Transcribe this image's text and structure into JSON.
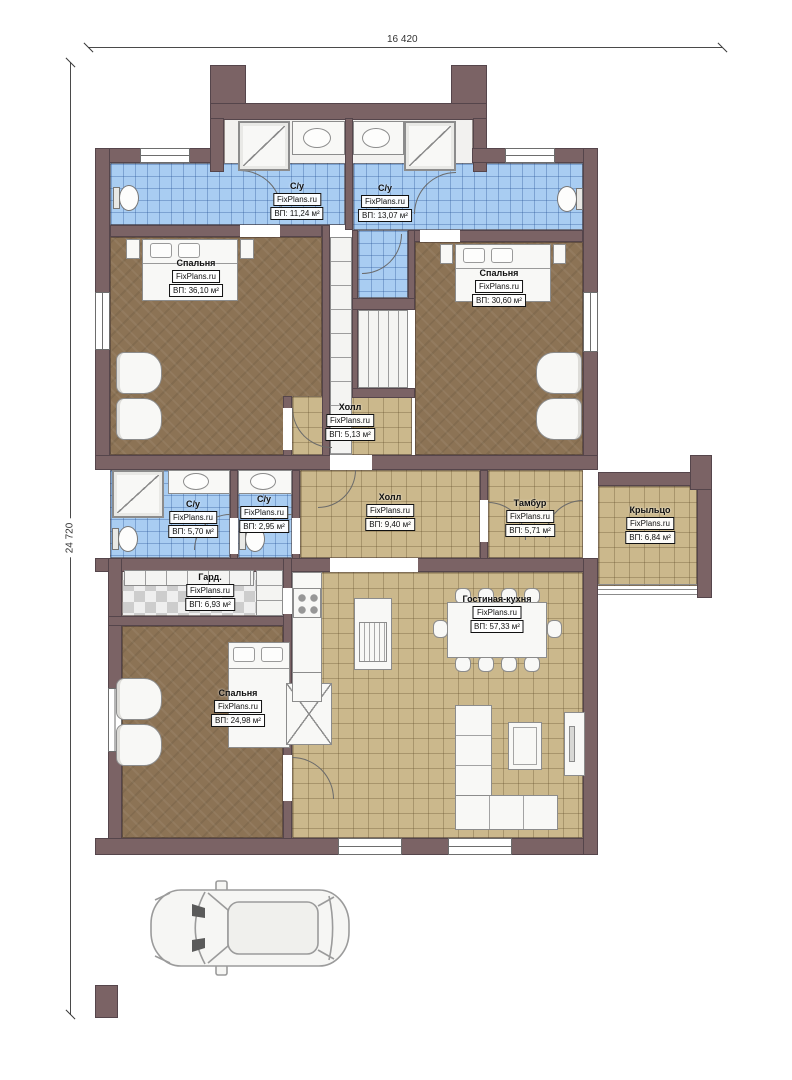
{
  "watermark": "FixPlans.ru",
  "dimensions": {
    "width": "16 420",
    "height": "24 720"
  },
  "rooms": [
    {
      "id": "su-top-left",
      "name": "С/у",
      "area": "ВП: 11,24 м²"
    },
    {
      "id": "su-top-right",
      "name": "С/у",
      "area": "ВП: 13,07 м²"
    },
    {
      "id": "bedroom-left",
      "name": "Спальня",
      "area": "ВП: 36,10 м²"
    },
    {
      "id": "bedroom-right",
      "name": "Спальня",
      "area": "ВП: 30,60 м²"
    },
    {
      "id": "hall-upper",
      "name": "Холл",
      "area": "ВП: 5,13 м²"
    },
    {
      "id": "su-mid-left",
      "name": "С/у",
      "area": "ВП: 5,70 м²"
    },
    {
      "id": "su-mid-right",
      "name": "С/у",
      "area": "ВП: 2,95 м²"
    },
    {
      "id": "hall-main",
      "name": "Холл",
      "area": "ВП: 9,40 м²"
    },
    {
      "id": "tambour",
      "name": "Тамбур",
      "area": "ВП: 5,71 м²"
    },
    {
      "id": "porch",
      "name": "Крыльцо",
      "area": "ВП: 6,84 м²"
    },
    {
      "id": "wardrobe",
      "name": "Гард.",
      "area": "ВП: 6,93 м²"
    },
    {
      "id": "living-kitchen",
      "name": "Гостиная-кухня",
      "area": "ВП: 57,33 м²"
    },
    {
      "id": "bedroom-bottom",
      "name": "Спальня",
      "area": "ВП: 24,98 м²"
    }
  ],
  "colors": {
    "wall": "#7b6365",
    "tile_blue": "#a9cdf2",
    "tile_beige": "#cbb88c",
    "floor_wood": "#8c7355",
    "fixture_white": "#f8f8f6"
  }
}
